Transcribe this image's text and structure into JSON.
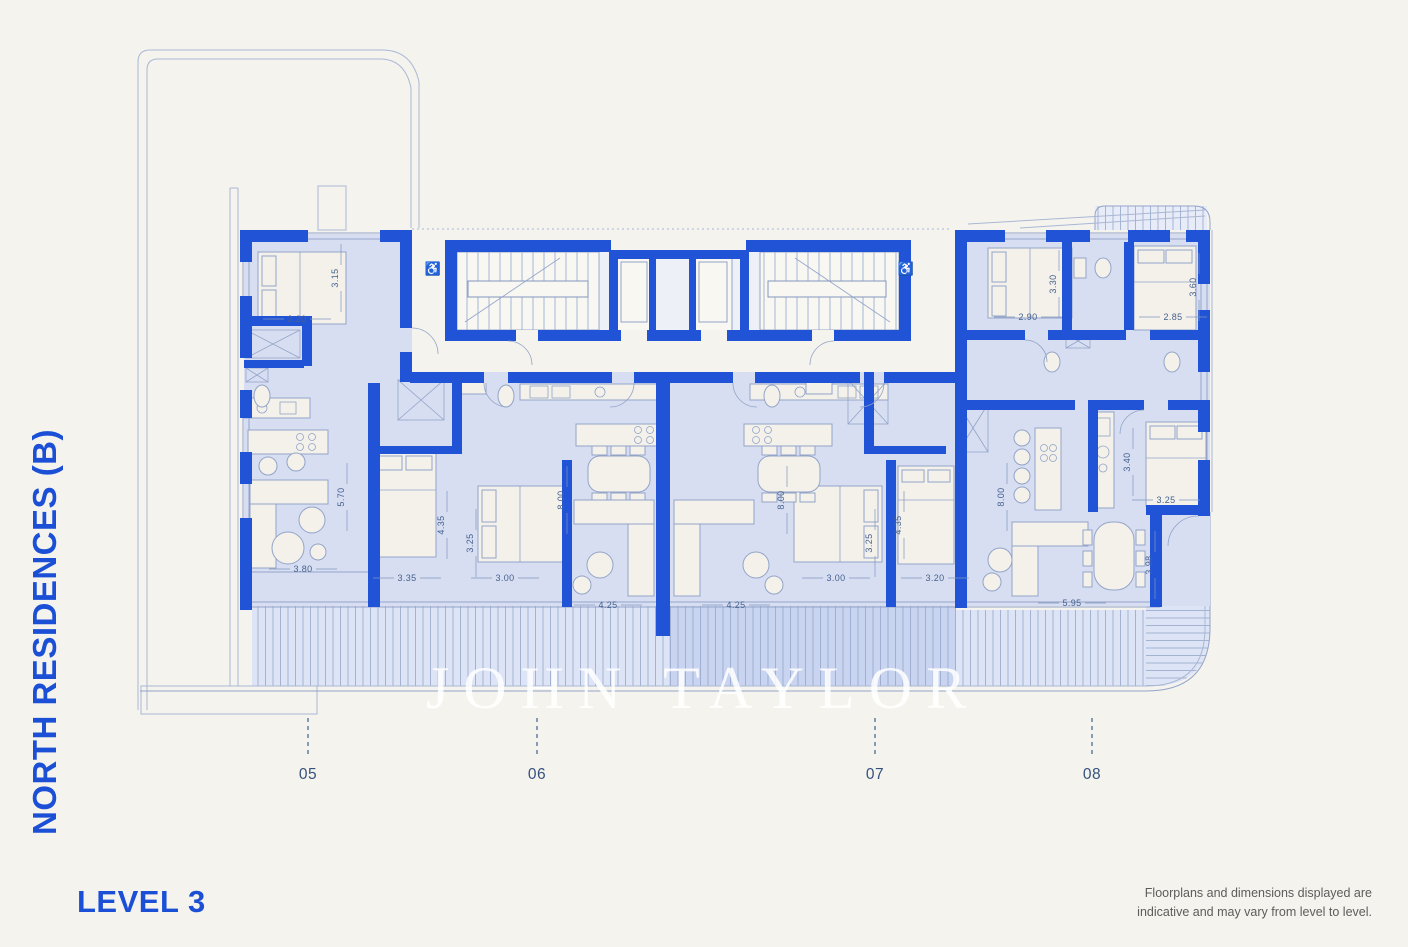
{
  "page": {
    "background": "#f4f3ee"
  },
  "branding": {
    "title_vertical": "NORTH RESIDENCES (B)",
    "level_label": "LEVEL 3",
    "watermark": "JOHN TAYLOR"
  },
  "disclaimer": {
    "line1": "Floorplans and dimensions displayed are",
    "line2": "indicative and may vary from level to level."
  },
  "colors": {
    "accent_blue": "#2153d6",
    "title_blue": "#1b50d6",
    "room_fill": "#d7def2",
    "balcony_fill": "#dde4f6",
    "balcony_fill_dark": "#c9d4f1",
    "hatch_line": "#95a6ca",
    "background": "#f4f3ee"
  },
  "units": [
    {
      "label": "05",
      "x": 308
    },
    {
      "label": "06",
      "x": 537
    },
    {
      "label": "07",
      "x": 875
    },
    {
      "label": "08",
      "x": 1092
    }
  ],
  "floorplan": {
    "dimensions": [
      {
        "t": "3.20",
        "x": 297,
        "y": 322
      },
      {
        "t": "3.15",
        "x": 338,
        "y": 278,
        "r": -90
      },
      {
        "t": "3.80",
        "x": 303,
        "y": 572
      },
      {
        "t": "5.70",
        "x": 344,
        "y": 497,
        "r": -90
      },
      {
        "t": "3.35",
        "x": 407,
        "y": 581
      },
      {
        "t": "4.35",
        "x": 444,
        "y": 525,
        "r": -90
      },
      {
        "t": "3.25",
        "x": 473,
        "y": 543,
        "r": -90
      },
      {
        "t": "3.00",
        "x": 505,
        "y": 581
      },
      {
        "t": "8.00",
        "x": 564,
        "y": 500,
        "r": -90
      },
      {
        "t": "4.25",
        "x": 608,
        "y": 608
      },
      {
        "t": "4.25",
        "x": 736,
        "y": 608
      },
      {
        "t": "8.00",
        "x": 784,
        "y": 500,
        "r": -90
      },
      {
        "t": "3.00",
        "x": 836,
        "y": 581
      },
      {
        "t": "3.25",
        "x": 872,
        "y": 543,
        "r": -90
      },
      {
        "t": "4.35",
        "x": 901,
        "y": 525,
        "r": -90
      },
      {
        "t": "3.20",
        "x": 935,
        "y": 581
      },
      {
        "t": "2.90",
        "x": 1028,
        "y": 320
      },
      {
        "t": "3.30",
        "x": 1056,
        "y": 284,
        "r": -90
      },
      {
        "t": "2.85",
        "x": 1173,
        "y": 320
      },
      {
        "t": "3.60",
        "x": 1196,
        "y": 287,
        "r": -90
      },
      {
        "t": "8.00",
        "x": 1004,
        "y": 497,
        "r": -90
      },
      {
        "t": "3.40",
        "x": 1130,
        "y": 462,
        "r": -90
      },
      {
        "t": "3.25",
        "x": 1166,
        "y": 503
      },
      {
        "t": "3.98",
        "x": 1152,
        "y": 565,
        "r": -90
      },
      {
        "t": "5.95",
        "x": 1072,
        "y": 606
      }
    ],
    "icons": [
      {
        "name": "wheelchair-accessible-icon",
        "x": 433,
        "y": 273
      },
      {
        "name": "wheelchair-accessible-icon",
        "x": 906,
        "y": 273
      }
    ]
  }
}
